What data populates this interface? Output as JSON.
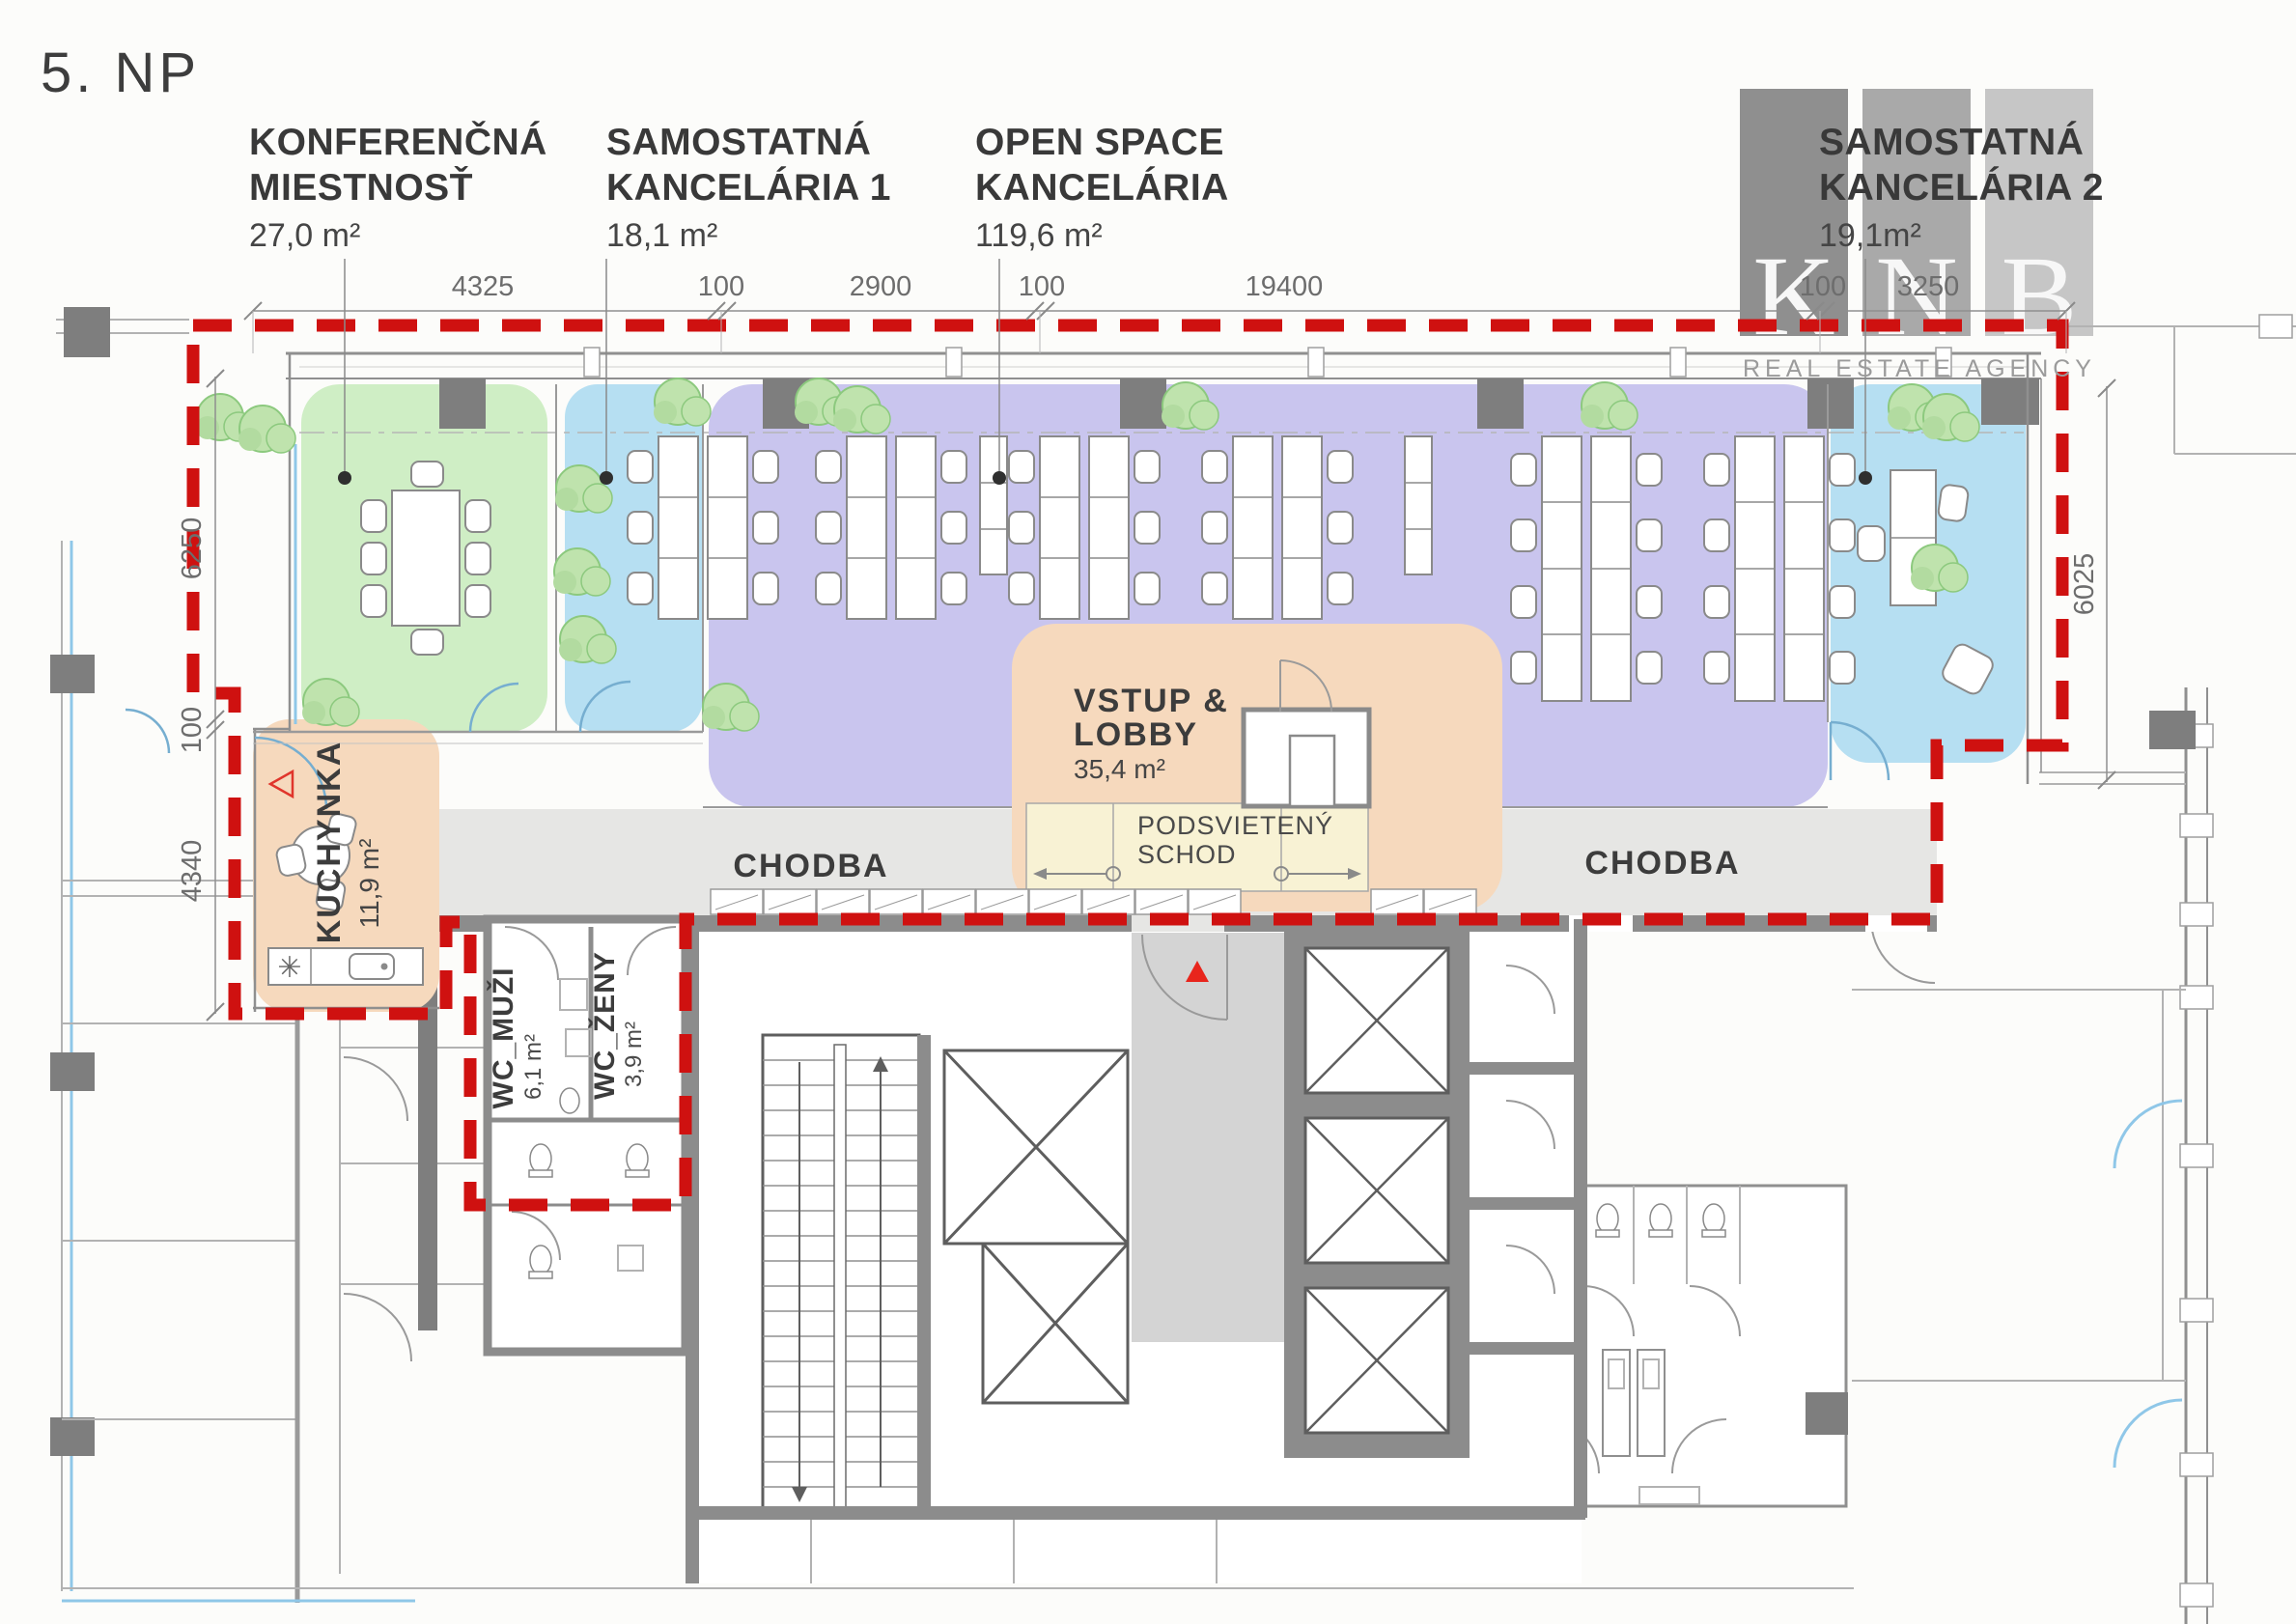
{
  "title": "5. NP",
  "logo": {
    "letter_k": "K",
    "letter_n": "N",
    "letter_b": "B",
    "tagline": "REAL ESTATE AGENCY"
  },
  "room_labels": [
    {
      "line1": "KONFERENČNÁ",
      "line2": "MIESTNOSŤ",
      "area": "27,0 m²"
    },
    {
      "line1": "SAMOSTATNÁ",
      "line2": "KANCELÁRIA 1",
      "area": "18,1 m²"
    },
    {
      "line1": "OPEN SPACE",
      "line2": "KANCELÁRIA",
      "area": "119,6 m²"
    },
    {
      "line1": "SAMOSTATNÁ",
      "line2": "KANCELÁRIA 2",
      "area": "19,1m²"
    }
  ],
  "plan_labels": {
    "kuchynka_name": "KUCHYNKA",
    "kuchynka_area": "11,9 m²",
    "chodba_left": "CHODBA",
    "chodba_right": "CHODBA",
    "lobby_line1": "VSTUP &",
    "lobby_line2": "LOBBY",
    "lobby_area": "35,4 m²",
    "schod_line1": "PODSVIETENÝ",
    "schod_line2": "SCHOD",
    "wc_men_name": "WC_MUŽI",
    "wc_men_area": "6,1 m²",
    "wc_women_name": "WC_ŽENY",
    "wc_women_area": "3,9 m²"
  },
  "dimensions": {
    "top": [
      "4325",
      "100",
      "2900",
      "100",
      "19400",
      "100",
      "3250"
    ],
    "left": [
      "6250",
      "100",
      "4340"
    ],
    "right": [
      "6025"
    ]
  },
  "colors": {
    "zone_green": "#cfeec5",
    "zone_blue": "#b6dff2",
    "zone_purple": "#c9c5ee",
    "zone_orange": "#f6d9bd",
    "schod_yellow": "#f8f2d4",
    "boundary_red": "#cf1110",
    "marker_red": "#e8251c",
    "wall_dark": "#7e7e7e",
    "corridor_gray": "#e6e6e4",
    "core_gray": "#d4d4d4",
    "bar_dark": "#8f8f8f",
    "bar_mid": "#a9a9a9",
    "bar_light": "#c6c6c6"
  }
}
